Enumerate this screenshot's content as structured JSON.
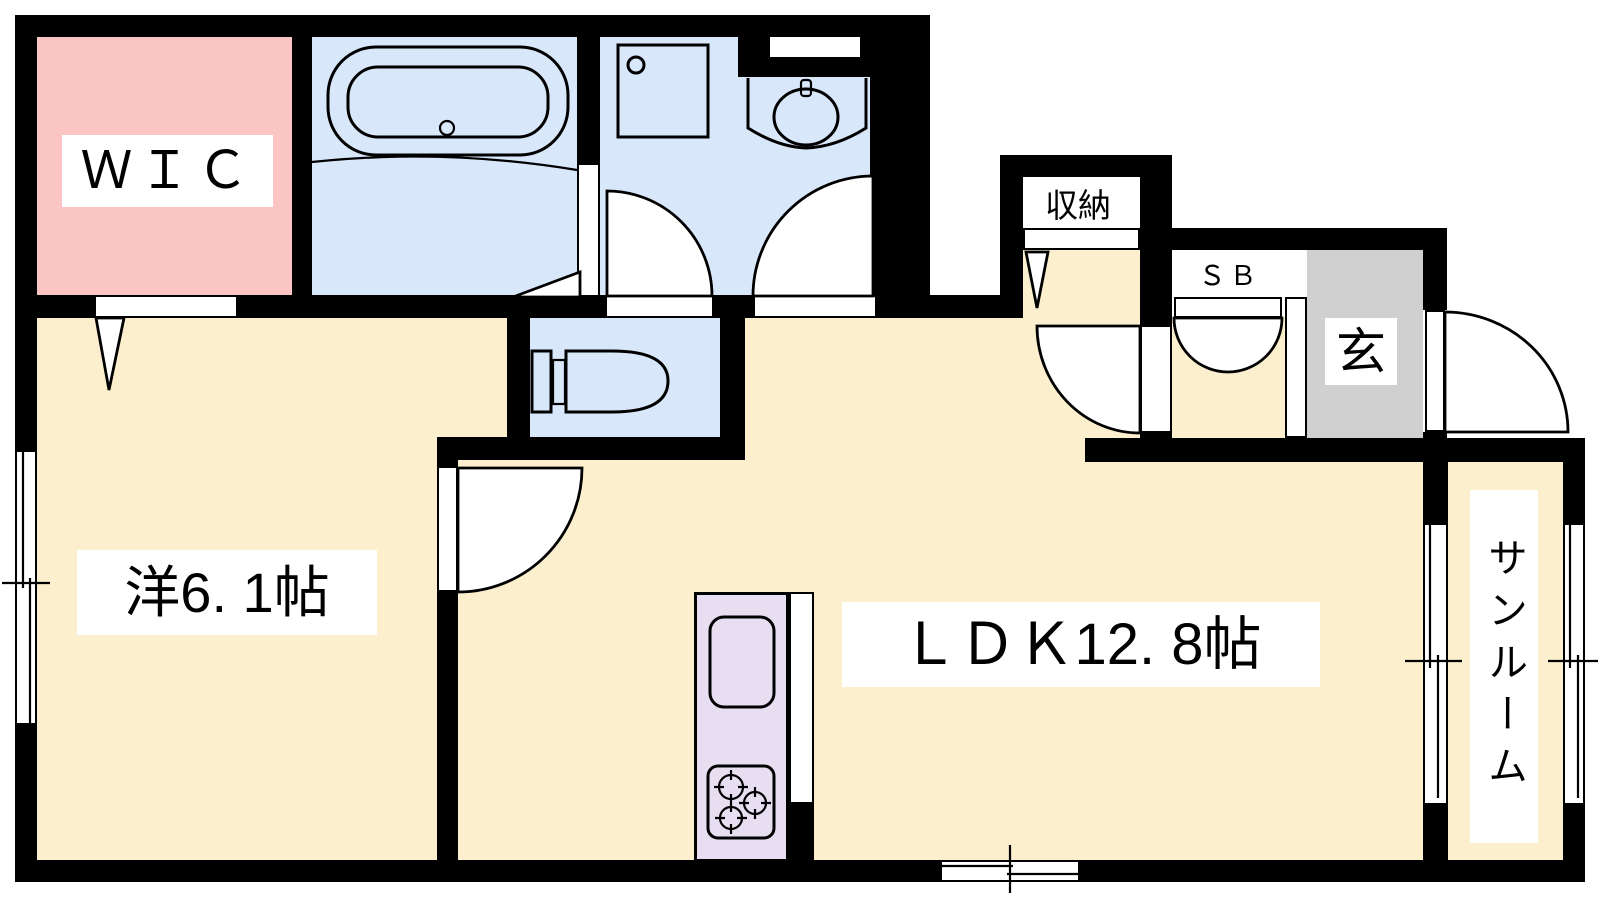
{
  "plan": {
    "rooms": {
      "wic": {
        "label": "ＷＩＣ"
      },
      "western_room": {
        "label": "洋6. 1帖"
      },
      "ldk": {
        "label": "ＬＤＫ12. 8帖"
      },
      "storage": {
        "label": "収納"
      },
      "shoe_box": {
        "label": "ＳＢ"
      },
      "entrance": {
        "label": "玄"
      },
      "sunroom": {
        "label": "サンルーム"
      }
    },
    "colors": {
      "wall": "#000000",
      "pink": "#fbc5c3",
      "blue": "#d9e7fb",
      "cream": "#fcefce",
      "lavender": "#e8def2",
      "gray": "#d0d0d0",
      "label_bg": "#ffffff",
      "canvas": "#ffffff"
    }
  }
}
